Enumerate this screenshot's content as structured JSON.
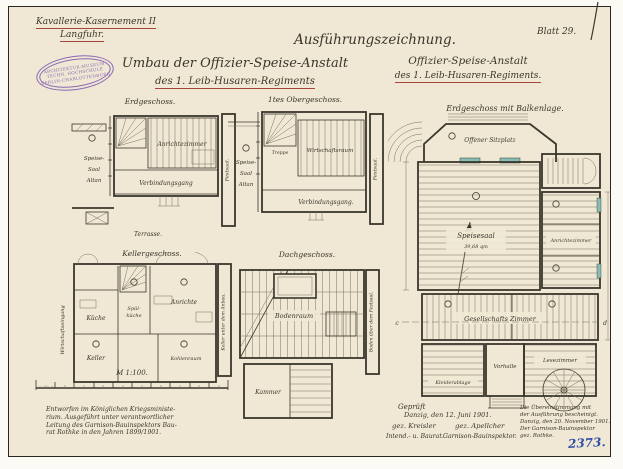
{
  "sheet": {
    "corner": {
      "line1": "Kavallerie-Kasernement II",
      "line2": "Langfuhr."
    },
    "stamp": {
      "line1": "ARCHITEKTUR-MUSEUM",
      "line2": "TECHN. HOCHSCHULE",
      "line3": "BERLIN-CHARLOTTENBURG"
    },
    "doc_type": "Ausführungszeichnung.",
    "sheet_no": "Blatt 29.",
    "title_left": {
      "line1": "Umbau der Offizier-Speise-Anstalt",
      "line2": "des 1. Leib-Husaren-Regiments"
    },
    "title_right": {
      "line1": "Offizier-Speise-Anstalt",
      "line2": "des 1. Leib-Husaren-Regiments."
    }
  },
  "plans": {
    "eg": {
      "title": "Erdgeschoss.",
      "speise": "Speise-",
      "saal": "Saal",
      "altan": "Altan",
      "anrichte": "Anrichtezimmer",
      "gang": "Verbindungsgang",
      "terrasse": "Terrasse.",
      "side": "Festsaal."
    },
    "og": {
      "title": "1tes Obergeschoss.",
      "treppe": "Treppe",
      "speise": "Speise-",
      "saal": "Saal",
      "altan": "Altan",
      "raum": "Wirtschaftsraum",
      "gang": "Verbindungsgang.",
      "side": "Festsaal."
    },
    "kg": {
      "title": "Kellergeschoss.",
      "kueche": "Küche",
      "spuel1": "Spül-",
      "spuel2": "küche",
      "anrichte": "Anrichte",
      "keller": "Keller",
      "kohlen": "Kohlenraum",
      "left": "Wirtschaftseingang",
      "side": "Keller unter dem Anbau."
    },
    "dg": {
      "title": "Dachgeschoss.",
      "boden": "Bodenraum",
      "kammer": "Kammer",
      "side": "Boden über dem Festsaal."
    },
    "main": {
      "title": "Erdgeschoss mit Balkenlage.",
      "sitzplatz": "Offener Sitzplatz",
      "speisesaal": "Speisesaal",
      "speisesaal_area": "39,68 qm",
      "anrichte": "Anrichtezimmer",
      "gesellschaft": "Gesellschafts Zimmer",
      "vorhalle": "Vorhalle",
      "lese": "Lesezimmer",
      "kleider": "Kleiderablage",
      "sec_c": "c",
      "sec_d": "d"
    }
  },
  "scale": {
    "label": "M 1:100."
  },
  "notes": {
    "left": [
      "Entworfen im Königlichen Kriegsministe-",
      "rium. Ausgeführt unter verantwortlicher",
      "Leitung des Garnison-Bauinspektors Bau-",
      "rat Rothke in den Jahren 1899/1901."
    ],
    "check": {
      "heading": "Geprüft",
      "date": "Danzig, den 12. Juni 1901.",
      "sig1": "gez. Kreisler",
      "sig2": "gez. Apellcher",
      "role1": "Intend.- u. Baurat.",
      "role2": "Garnison-Bauinspektor."
    },
    "right": [
      "Die Übereinstimmung mit",
      "der Ausführung bescheinigt.",
      "Danzig, den 20. November 1901.",
      "Der Garnison-Bauinspektor",
      "gez. Rothke."
    ],
    "inventory_no": "2373."
  },
  "colors": {
    "paper": "#f0e8d4",
    "ink": "#3b362c",
    "red": "#a6453a",
    "blue": "#3050a8",
    "violet": "#8a68b5",
    "teal": "#86bdb4"
  }
}
